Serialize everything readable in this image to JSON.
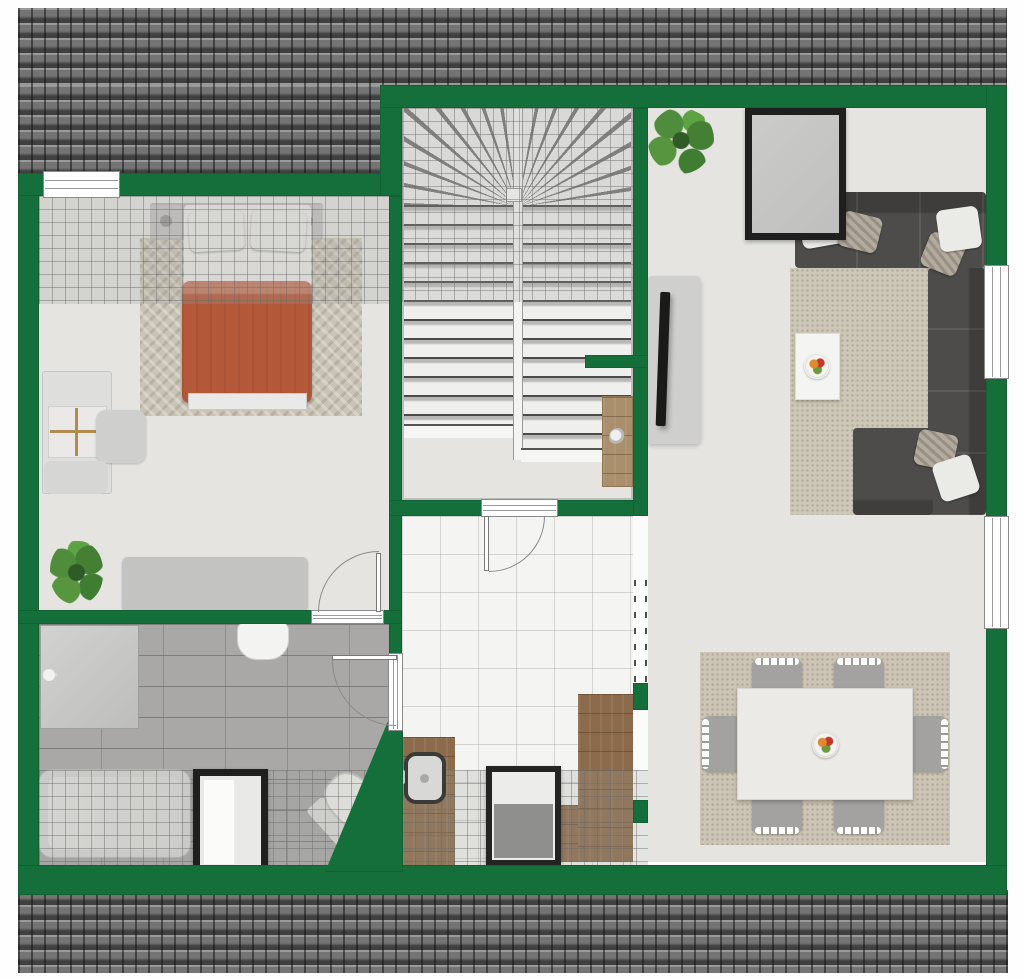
{
  "meta": {
    "kind": "floor-plan",
    "width_px": 1024,
    "height_px": 979,
    "visible_text": []
  },
  "palette": {
    "wall_green": "#156f3b",
    "roof_gray": "#757474",
    "floor_light": "#e5e4e1",
    "bath_tile": "#a9a8a7",
    "hall_tile": "#f4f4f2",
    "wood_brown": "#8b6b4b",
    "sofa_gray": "#4d4c4a",
    "duvet_orange": "#b4583a",
    "rug_beige": "#cdc7b7",
    "frame_black": "#1f1f1f",
    "plant_green": "#4f8c3c"
  },
  "rooms": [
    {
      "name": "bedroom",
      "position": "top-left",
      "items": [
        "double-bed-orange-duvet",
        "headboard-with-two-nightstands",
        "herringbone-rug",
        "desk-with-drawers",
        "desk-chair",
        "bench",
        "potted-plant",
        "low-dresser",
        "window-top-wall",
        "door-bottom-right"
      ]
    },
    {
      "name": "staircase-hall",
      "position": "top-center",
      "items": [
        "u-shaped-winder-staircase",
        "wood-sideboard-with-plant-pot",
        "door-to-hallway"
      ]
    },
    {
      "name": "living-room",
      "position": "right",
      "items": [
        "corner-sofa-dark-gray",
        "throw-pillows",
        "beige-rug",
        "coffee-table-with-fruit-bowl",
        "tv-on-lowboard",
        "wall-mirror-black-frame",
        "potted-plant",
        "two-windows-right-wall"
      ]
    },
    {
      "name": "dining-area",
      "position": "bottom-right",
      "items": [
        "dining-table-white",
        "six-gray-chairs",
        "fruit-bowl",
        "beige-rug"
      ]
    },
    {
      "name": "bathroom",
      "position": "bottom-left",
      "items": [
        "shower",
        "wall-sink",
        "bathtub",
        "roof-window-skylight",
        "toilet",
        "sloped-roof-overlay",
        "angled-wall",
        "door-to-hallway"
      ]
    },
    {
      "name": "hallway",
      "position": "bottom-center",
      "items": [
        "white-floor-tiles",
        "wood-vanity-with-basin",
        "appliance-cabinet",
        "wood-floor-section",
        "dashed-open-passage",
        "sloped-roof-overlay"
      ]
    }
  ],
  "roof": {
    "top_band": true,
    "bottom_band": true,
    "semi_transparent_slope_overlays": 4
  }
}
